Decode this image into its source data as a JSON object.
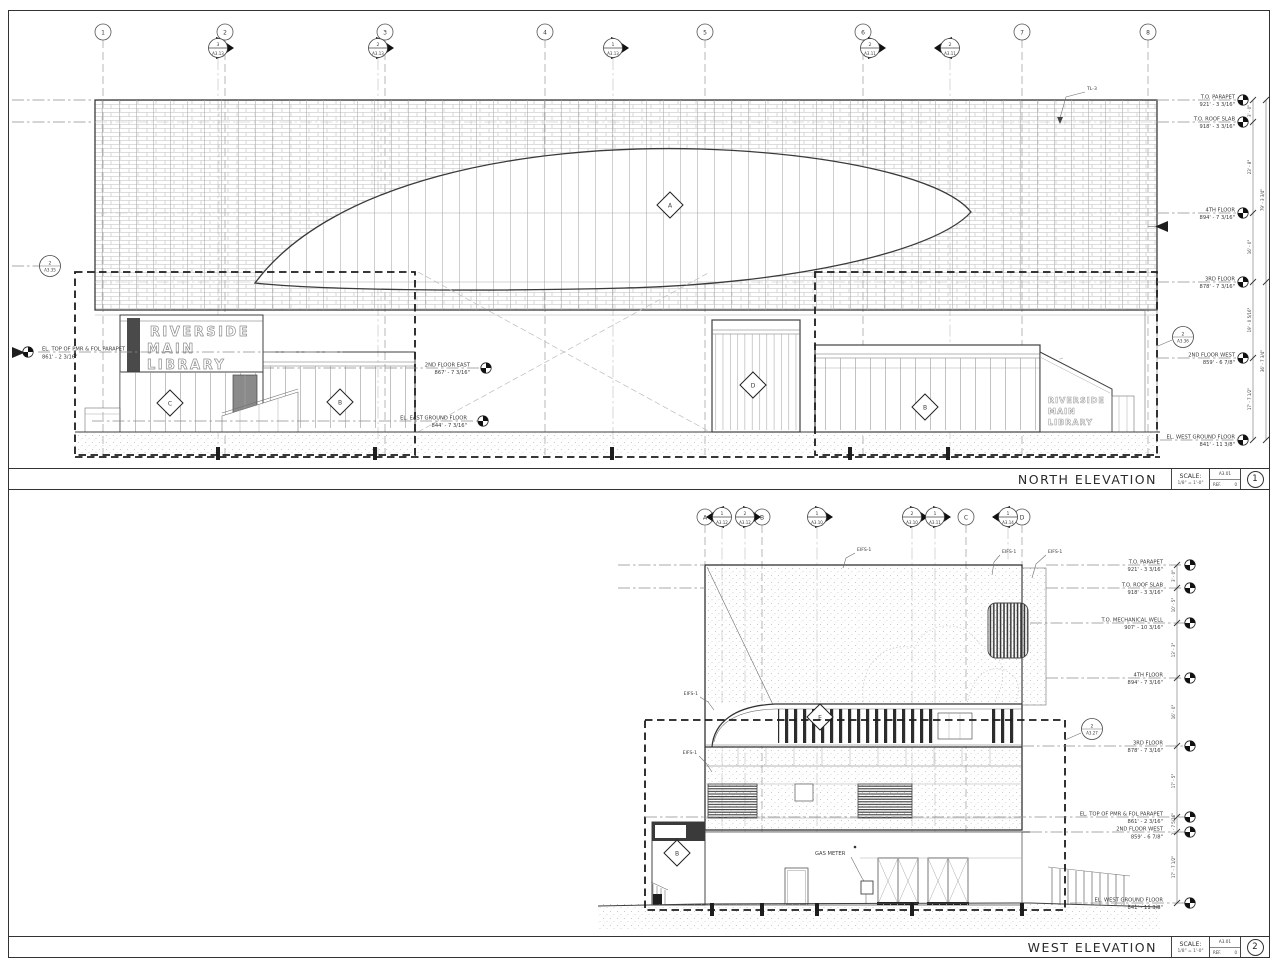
{
  "sheet": {
    "title_north": "NORTH ELEVATION",
    "title_west": "WEST ELEVATION",
    "scale_label": "SCALE:",
    "scale_value": "1/8\" = 1'-0\"",
    "sheet_number": "A3.01",
    "ref_label": "REF.",
    "ref_value": "0",
    "viewport_north": "1",
    "viewport_west": "2"
  },
  "north": {
    "grids": [
      "1",
      "2",
      "3",
      "4",
      "5",
      "6",
      "7",
      "8"
    ],
    "markers": [
      {
        "n": "3",
        "s": "A3.13"
      },
      {
        "n": "2",
        "s": "A3.13"
      },
      {
        "n": "1",
        "s": "A3.13"
      },
      {
        "n": "2",
        "s": "A3.11"
      },
      {
        "n": "2",
        "s": "A3.11"
      }
    ],
    "levels": [
      {
        "name": "T.O. PARAPET",
        "elev": "921' - 3 3/16\""
      },
      {
        "name": "T.O. ROOF SLAB",
        "elev": "918' - 3 3/16\""
      },
      {
        "name": "4TH FLOOR",
        "elev": "894' - 7 3/16\""
      },
      {
        "name": "3RD FLOOR",
        "elev": "878' - 7 3/16\""
      },
      {
        "name": "2ND FLOOR WEST",
        "elev": "859' - 6 7/8\""
      },
      {
        "name": "EL. WEST GROUND FLOOR",
        "elev": "841' - 11 3/8\""
      }
    ],
    "mid_levels": [
      {
        "name": "2ND FLOOR EAST",
        "elev": "867' - 7 3/16\""
      },
      {
        "name": "EL. EAST GROUND FLOOR",
        "elev": "844' - 7 3/16\""
      }
    ],
    "left_level": {
      "name": "EL. TOP OF PMR & FOL PARAPET",
      "elev": "861' - 2 3/16\""
    },
    "detail_left": {
      "n": "2",
      "s": "A3.35"
    },
    "detail_right": {
      "n": "2",
      "s": "A3.36"
    },
    "material_tag": "TL-3",
    "sign": [
      "RIVERSIDE",
      "MAIN",
      "LIBRARY"
    ],
    "keynotes": {
      "a": "A",
      "b": "B",
      "c": "C",
      "d": "D"
    },
    "dims": [
      "3' - 0\"",
      "23' - 8\"",
      "16' - 0\"",
      "19' - 0 5/16\"",
      "17' - 7 1/2\""
    ],
    "dims_outer": [
      "79' - 3 3/4\"",
      "36' - 7 3/4\""
    ]
  },
  "west": {
    "grids": [
      "A",
      "B",
      "C",
      "D"
    ],
    "markers": [
      {
        "n": "1",
        "s": "A3.12"
      },
      {
        "n": "2",
        "s": "A3.12"
      },
      {
        "n": "1",
        "s": "A3.10"
      },
      {
        "n": "2",
        "s": "A3.10"
      },
      {
        "n": "1",
        "s": "A3.11"
      },
      {
        "n": "1",
        "s": "A3.14"
      }
    ],
    "levels": [
      {
        "name": "T.O. PARAPET",
        "elev": "921' - 3 3/16\""
      },
      {
        "name": "T.O. ROOF SLAB",
        "elev": "918' - 3 3/16\""
      },
      {
        "name": "T.O. MECHANICAL WELL",
        "elev": "907' - 10 3/16\""
      },
      {
        "name": "4TH FLOOR",
        "elev": "894' - 7 3/16\""
      },
      {
        "name": "3RD FLOOR",
        "elev": "878' - 7 3/16\""
      },
      {
        "name": "EL. TOP OF PMR & FOL PARAPET",
        "elev": "861' - 2 3/16\""
      },
      {
        "name": "2ND FLOOR WEST",
        "elev": "859' - 6 7/8\""
      },
      {
        "name": "EL. WEST GROUND FLOOR",
        "elev": "841' - 11 3/8\""
      }
    ],
    "detail": {
      "n": "2",
      "s": "A3.27"
    },
    "material_tag": "EIFS-1",
    "gas_meter": "GAS METER",
    "keynotes": {
      "e": "E",
      "b": "B"
    },
    "dims": [
      "3' - 0\"",
      "10' - 5\"",
      "13' - 3\"",
      "16' - 0\"",
      "17' - 5\"",
      "1' - 7 5/16\"",
      "17' - 7 1/2\""
    ]
  }
}
